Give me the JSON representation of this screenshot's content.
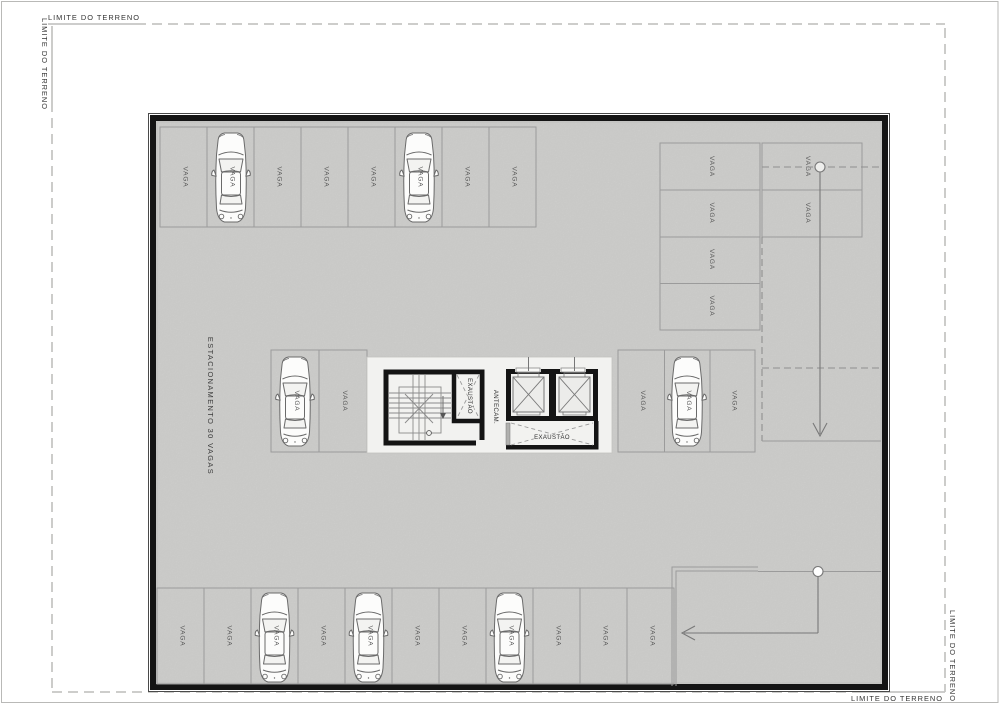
{
  "drawing": {
    "type": "parking-garage-floor-plan",
    "labels": {
      "site_boundary": "LIMITE DO TERRENO",
      "parking_title": "ESTACIONAMENTO 30 VAGAS",
      "space": "VAGA",
      "exhaust": "EXAUSTÃO",
      "antechamber": "ANTECAM."
    },
    "spaces": {
      "total": 30,
      "rows": {
        "top_row_count": 8,
        "top_right_column_count": 4,
        "right_lane_count": 2,
        "middle_left_count": 2,
        "middle_right_count": 3,
        "bottom_row_count": 11
      },
      "cars_parked": 7
    },
    "colors": {
      "floor": "#d5d5d3",
      "core_floor": "#f2f2f0",
      "wall": "#141414",
      "parking_line": "#9b9b9b",
      "boundary_line": "#c6c6c4",
      "label_text": "#3c3c3c"
    }
  }
}
